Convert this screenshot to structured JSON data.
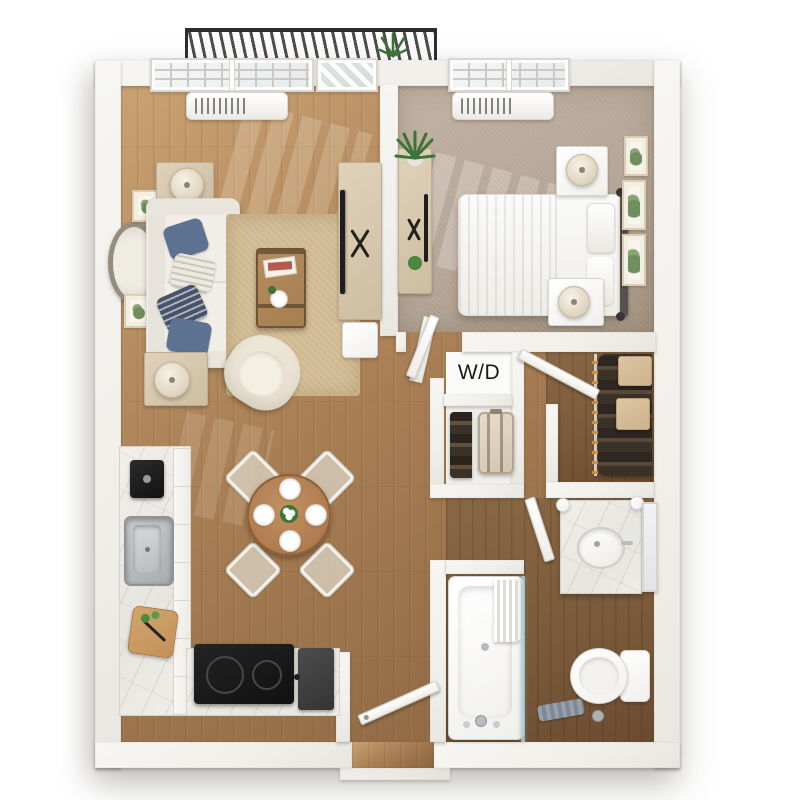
{
  "meta": {
    "type": "3d-floor-plan-render",
    "description": "Top-down 3D render of a one-bedroom, one-bath apartment with balcony, open living/dining/kitchen, walk-in closet, W/D closet and bathroom"
  },
  "labels": {
    "washer_dryer": "W/D"
  },
  "palette": {
    "bg": "#ffffff",
    "wall": "#f1efea",
    "wood-light": "#c9a172",
    "wood-main": "#a87e54",
    "wood-dark": "#8a6540",
    "wood-bath": "#7a593a",
    "carpet": "#b4a494",
    "rug": "#d5bf99",
    "sofa": "#f1eee8",
    "pillow-blue": "#5d7191",
    "pillow-navy": "#47536b",
    "table-wood": "#b07c4f",
    "trunk-wood": "#a57e52",
    "appliance-dark": "#1b1b1b",
    "railing": "#2d2d2d",
    "plant": "#3c7339",
    "clothes": "#3a3127",
    "hanger": "#c8913f",
    "box-tan": "#cdb38e",
    "fixture-edge": "#d6d4cf",
    "steel": "#b9bdbe",
    "text": "#1a1a1a"
  }
}
